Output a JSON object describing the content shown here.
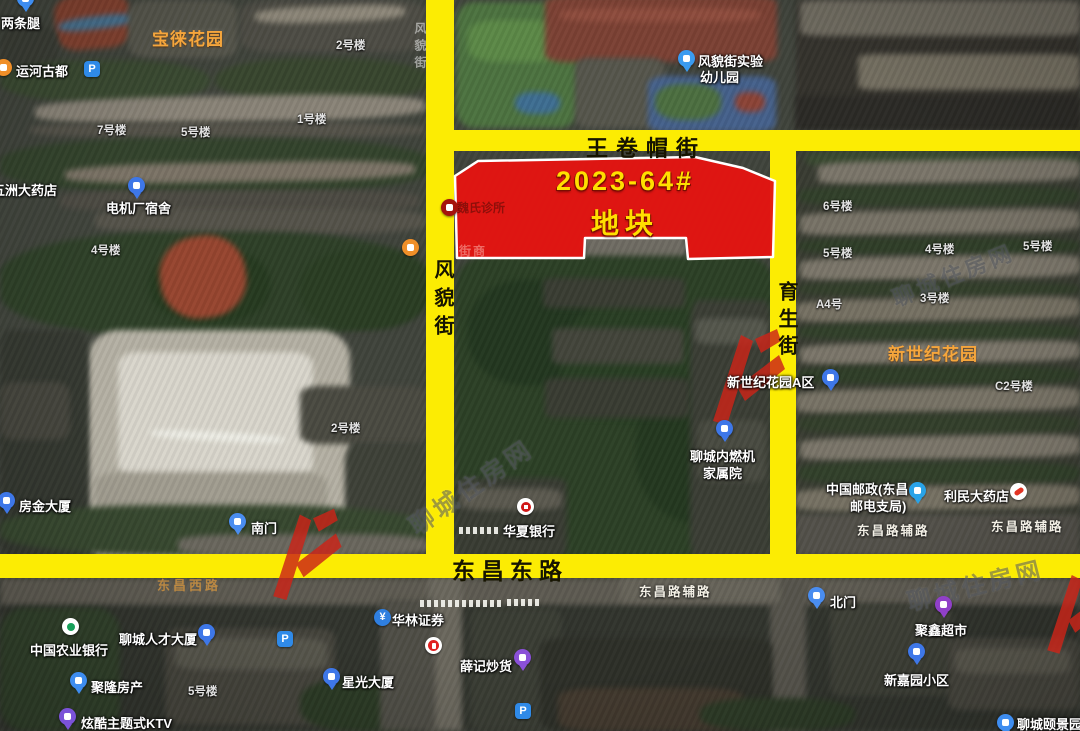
{
  "parcel": {
    "line1": "2023-64#",
    "line2": "地块",
    "fill": "#e51411",
    "text_color": "#ffdf00"
  },
  "roads": {
    "wjm": "王卷帽街",
    "fm": "风貌街",
    "ys": "育生街",
    "dcd": "东昌东路",
    "ghost": "风貌街",
    "faint": "东昌西路",
    "color": "#fcec03"
  },
  "watermark": {
    "text": "聊城住房网",
    "logo_color": "#cc2418"
  },
  "pois": [
    {
      "t": "两条腿",
      "x": 1,
      "y": 13,
      "k": "poi"
    },
    {
      "t": "宝徕花园",
      "x": 152,
      "y": 25,
      "k": "estate"
    },
    {
      "t": "2号楼",
      "x": 336,
      "y": 37,
      "k": "sm"
    },
    {
      "t": "运河古都",
      "x": 16,
      "y": 61,
      "k": "poi"
    },
    {
      "t": "7号楼",
      "x": 97,
      "y": 122,
      "k": "sm"
    },
    {
      "t": "5号楼",
      "x": 181,
      "y": 124,
      "k": "sm"
    },
    {
      "t": "1号楼",
      "x": 297,
      "y": 111,
      "k": "sm"
    },
    {
      "t": "五洲大药店",
      "x": -8,
      "y": 180,
      "k": "poi"
    },
    {
      "t": "电机厂宿舍",
      "x": 106,
      "y": 198,
      "k": "poi"
    },
    {
      "t": "风貌街实验",
      "x": 698,
      "y": 51,
      "k": "poi"
    },
    {
      "t": "幼儿园",
      "x": 700,
      "y": 67,
      "k": "poi"
    },
    {
      "t": "4号楼",
      "x": 91,
      "y": 242,
      "k": "sm"
    },
    {
      "t": "2号楼",
      "x": 331,
      "y": 420,
      "k": "sm"
    },
    {
      "t": "房金大厦",
      "x": 19,
      "y": 496,
      "k": "poi"
    },
    {
      "t": "南门",
      "x": 251,
      "y": 518,
      "k": "poi"
    },
    {
      "t": "魏氏诊所",
      "x": 457,
      "y": 199,
      "k": "inparcel"
    },
    {
      "t": "街商",
      "x": 459,
      "y": 242,
      "k": "inparcelfaint"
    },
    {
      "t": "聊城内燃机",
      "x": 690,
      "y": 446,
      "k": "poi"
    },
    {
      "t": "家属院",
      "x": 703,
      "y": 463,
      "k": "poi"
    },
    {
      "t": "新世纪花园A区",
      "x": 727,
      "y": 372,
      "k": "poi"
    },
    {
      "t": "新世纪花园",
      "x": 888,
      "y": 340,
      "k": "estate"
    },
    {
      "t": "C2号楼",
      "x": 995,
      "y": 378,
      "k": "sm"
    },
    {
      "t": "6号楼",
      "x": 823,
      "y": 198,
      "k": "sm"
    },
    {
      "t": "5号楼",
      "x": 823,
      "y": 245,
      "k": "sm"
    },
    {
      "t": "4号楼",
      "x": 925,
      "y": 241,
      "k": "sm"
    },
    {
      "t": "5号楼",
      "x": 1023,
      "y": 238,
      "k": "sm"
    },
    {
      "t": "A4号",
      "x": 816,
      "y": 296,
      "k": "sm"
    },
    {
      "t": "3号楼",
      "x": 920,
      "y": 290,
      "k": "sm"
    },
    {
      "t": "中国邮政(东昌",
      "x": 826,
      "y": 479,
      "k": "poi"
    },
    {
      "t": "邮电支局)",
      "x": 850,
      "y": 496,
      "k": "poi"
    },
    {
      "t": "利民大药店",
      "x": 944,
      "y": 486,
      "k": "poi"
    },
    {
      "t": "东昌路辅路",
      "x": 857,
      "y": 520,
      "k": "sub"
    },
    {
      "t": "东昌路辅路",
      "x": 991,
      "y": 516,
      "k": "sub"
    },
    {
      "t": "东昌路辅路",
      "x": 639,
      "y": 581,
      "k": "sub"
    },
    {
      "t": "华夏银行",
      "x": 503,
      "y": 521,
      "k": "poi"
    },
    {
      "t": "东昌西路",
      "x": 157,
      "y": 575,
      "k": "faintroad"
    },
    {
      "t": "华林证券",
      "x": 392,
      "y": 610,
      "k": "poi"
    },
    {
      "t": "北门",
      "x": 830,
      "y": 592,
      "k": "poi"
    },
    {
      "t": "聚鑫超市",
      "x": 915,
      "y": 620,
      "k": "poi"
    },
    {
      "t": "新嘉园小区",
      "x": 884,
      "y": 670,
      "k": "poi"
    },
    {
      "t": "聊城颐景园",
      "x": 1017,
      "y": 714,
      "k": "poi"
    },
    {
      "t": "中国农业银行",
      "x": 30,
      "y": 640,
      "k": "poi"
    },
    {
      "t": "聊城人才大厦",
      "x": 119,
      "y": 629,
      "k": "poi"
    },
    {
      "t": "聚隆房产",
      "x": 91,
      "y": 677,
      "k": "poi"
    },
    {
      "t": "5号楼",
      "x": 188,
      "y": 683,
      "k": "sm"
    },
    {
      "t": "星光大厦",
      "x": 342,
      "y": 672,
      "k": "poi"
    },
    {
      "t": "炫酷主题式KTV",
      "x": 81,
      "y": 713,
      "k": "poi"
    },
    {
      "t": "薛记炒货",
      "x": 460,
      "y": 656,
      "k": "poi"
    }
  ],
  "icons": [
    {
      "n": "poi-pin-icon",
      "k": "pin",
      "x": 17,
      "y": -10,
      "c": "#3e8df0",
      "g": "box"
    },
    {
      "n": "restaurant-icon",
      "k": "dot",
      "x": -5,
      "y": 59,
      "c": "#f08f28",
      "g": "box"
    },
    {
      "n": "parking-icon",
      "k": "sq",
      "x": 84,
      "y": 61,
      "c": "#2f8ae8",
      "g": "P"
    },
    {
      "n": "bank-pin-icon",
      "k": "pin",
      "x": 128,
      "y": 177,
      "c": "#3e77e8",
      "g": "box"
    },
    {
      "n": "kindergarten-pin-icon",
      "k": "pin",
      "x": 678,
      "y": 50,
      "c": "#3a9bf0",
      "g": "box"
    },
    {
      "n": "shop-icon",
      "k": "dot",
      "x": 402,
      "y": 239,
      "c": "#f08f28",
      "g": "box"
    },
    {
      "n": "bank-pin-icon",
      "k": "pin",
      "x": -2,
      "y": 492,
      "c": "#3e77e8",
      "g": "box"
    },
    {
      "n": "gate-pin-icon",
      "k": "pin",
      "x": 229,
      "y": 513,
      "c": "#4a8df0",
      "g": "box"
    },
    {
      "n": "clinic-icon",
      "k": "dot",
      "x": 441,
      "y": 199,
      "c": "#a5130d",
      "g": "box"
    },
    {
      "n": "bank-pin-icon",
      "k": "pin",
      "x": 716,
      "y": 420,
      "c": "#3e77e8",
      "g": "box"
    },
    {
      "n": "bank-pin-icon",
      "k": "pin",
      "x": 822,
      "y": 369,
      "c": "#3e77e8",
      "g": "box"
    },
    {
      "n": "post-office-pin-icon",
      "k": "pin",
      "x": 909,
      "y": 482,
      "c": "#29a3e8",
      "g": "box"
    },
    {
      "n": "pharmacy-icon",
      "k": "dot",
      "x": 1010,
      "y": 483,
      "c": "#ffffff",
      "g": "pill"
    },
    {
      "n": "bank-pin-icon",
      "k": "pin",
      "x": 908,
      "y": 643,
      "c": "#3e77e8",
      "g": "box"
    },
    {
      "n": "supermarket-pin-icon",
      "k": "pin",
      "x": 935,
      "y": 596,
      "c": "#9040c8",
      "g": "box"
    },
    {
      "n": "gate-pin-icon",
      "k": "pin",
      "x": 808,
      "y": 587,
      "c": "#4a8df0",
      "g": "box"
    },
    {
      "n": "estate-pin-icon",
      "k": "pin",
      "x": 997,
      "y": 714,
      "c": "#3e8df0",
      "g": "box"
    },
    {
      "n": "securities-icon",
      "k": "dot",
      "x": 374,
      "y": 609,
      "c": "#2f7fe0",
      "g": "¥"
    },
    {
      "n": "fastfood-icon",
      "k": "dot",
      "x": 425,
      "y": 637,
      "c": "#ffffff",
      "g": "red"
    },
    {
      "n": "snack-pin-icon",
      "k": "pin",
      "x": 514,
      "y": 649,
      "c": "#8a50d8",
      "g": "box"
    },
    {
      "n": "parking-icon",
      "k": "sq",
      "x": 515,
      "y": 703,
      "c": "#2f8ae8",
      "g": "P"
    },
    {
      "n": "abc-bank-icon",
      "k": "dot",
      "x": 62,
      "y": 618,
      "c": "#ffffff",
      "g": "grn"
    },
    {
      "n": "bank-pin-icon",
      "k": "pin",
      "x": 198,
      "y": 624,
      "c": "#3e77e8",
      "g": "box"
    },
    {
      "n": "parking-icon",
      "k": "sq",
      "x": 277,
      "y": 631,
      "c": "#2f8ae8",
      "g": "P"
    },
    {
      "n": "realty-pin-icon",
      "k": "pin",
      "x": 70,
      "y": 672,
      "c": "#3e8df0",
      "g": "box"
    },
    {
      "n": "bank-pin-icon",
      "k": "pin",
      "x": 323,
      "y": 668,
      "c": "#3e77e8",
      "g": "box"
    },
    {
      "n": "ktv-pin-icon",
      "k": "pin",
      "x": 59,
      "y": 708,
      "c": "#7b52d8",
      "g": "box"
    },
    {
      "n": "huaxia-bank-icon",
      "k": "dot",
      "x": 517,
      "y": 498,
      "c": "#ffffff",
      "g": "hx"
    }
  ]
}
